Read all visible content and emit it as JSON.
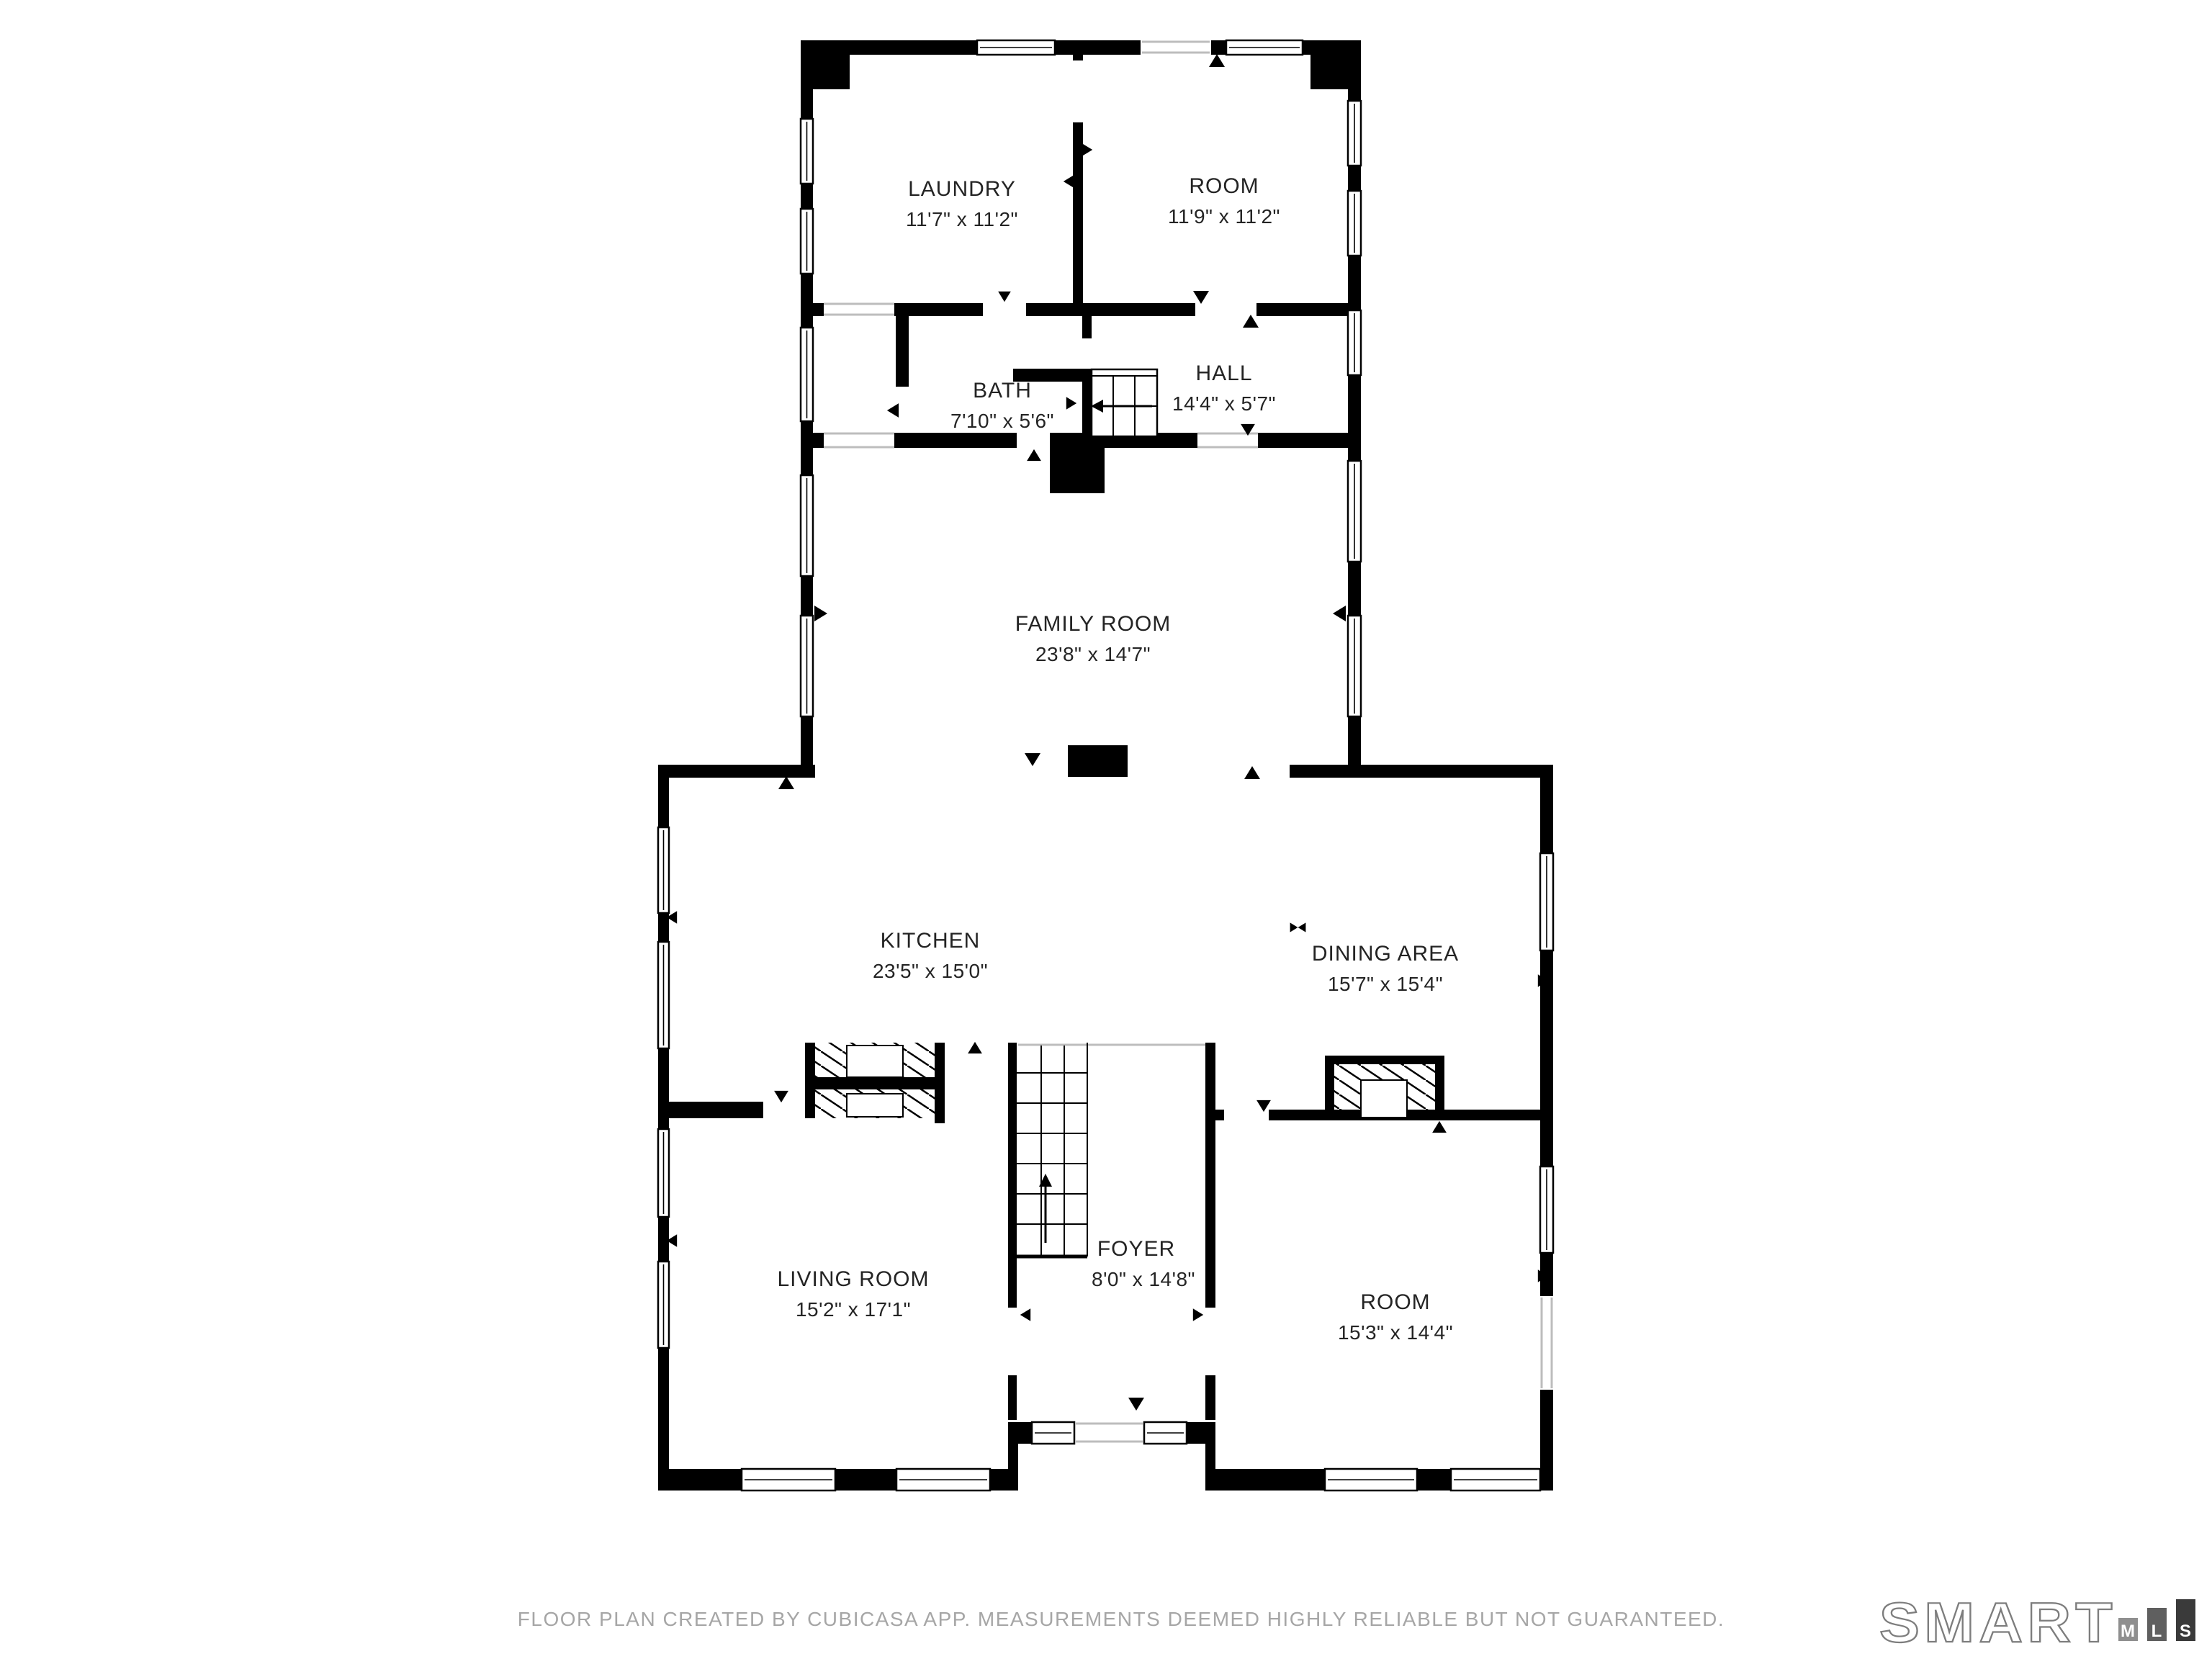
{
  "rooms": {
    "laundry": {
      "name": "LAUNDRY",
      "dims": "11'7\" x 11'2\""
    },
    "room_upper": {
      "name": "ROOM",
      "dims": "11'9\" x 11'2\""
    },
    "bath": {
      "name": "BATH",
      "dims": "7'10\" x 5'6\""
    },
    "hall": {
      "name": "HALL",
      "dims": "14'4\" x 5'7\""
    },
    "family_room": {
      "name": "FAMILY ROOM",
      "dims": "23'8\" x 14'7\""
    },
    "kitchen": {
      "name": "KITCHEN",
      "dims": "23'5\" x 15'0\""
    },
    "dining_area": {
      "name": "DINING AREA",
      "dims": "15'7\" x 15'4\""
    },
    "living_room": {
      "name": "LIVING ROOM",
      "dims": "15'2\" x 17'1\""
    },
    "foyer": {
      "name": "FOYER",
      "dims": "8'0\" x 14'8\""
    },
    "room_lower": {
      "name": "ROOM",
      "dims": "15'3\" x 14'4\""
    }
  },
  "footer": {
    "disclaimer": "FLOOR PLAN CREATED BY CUBICASA APP. MEASUREMENTS DEEMED HIGHLY RELIABLE BUT NOT GUARANTEED."
  },
  "logo": {
    "brand": "SMART",
    "mls": [
      "M",
      "L",
      "S"
    ]
  },
  "colors": {
    "wall": "#000000",
    "label": "#242424",
    "footer_text": "#a6a6a6",
    "logo_outline": "#7d7d7d",
    "logo_bar_m": "#8f8f8f",
    "logo_bar_l": "#5f5f5f",
    "logo_bar_s": "#3a3a3a"
  }
}
